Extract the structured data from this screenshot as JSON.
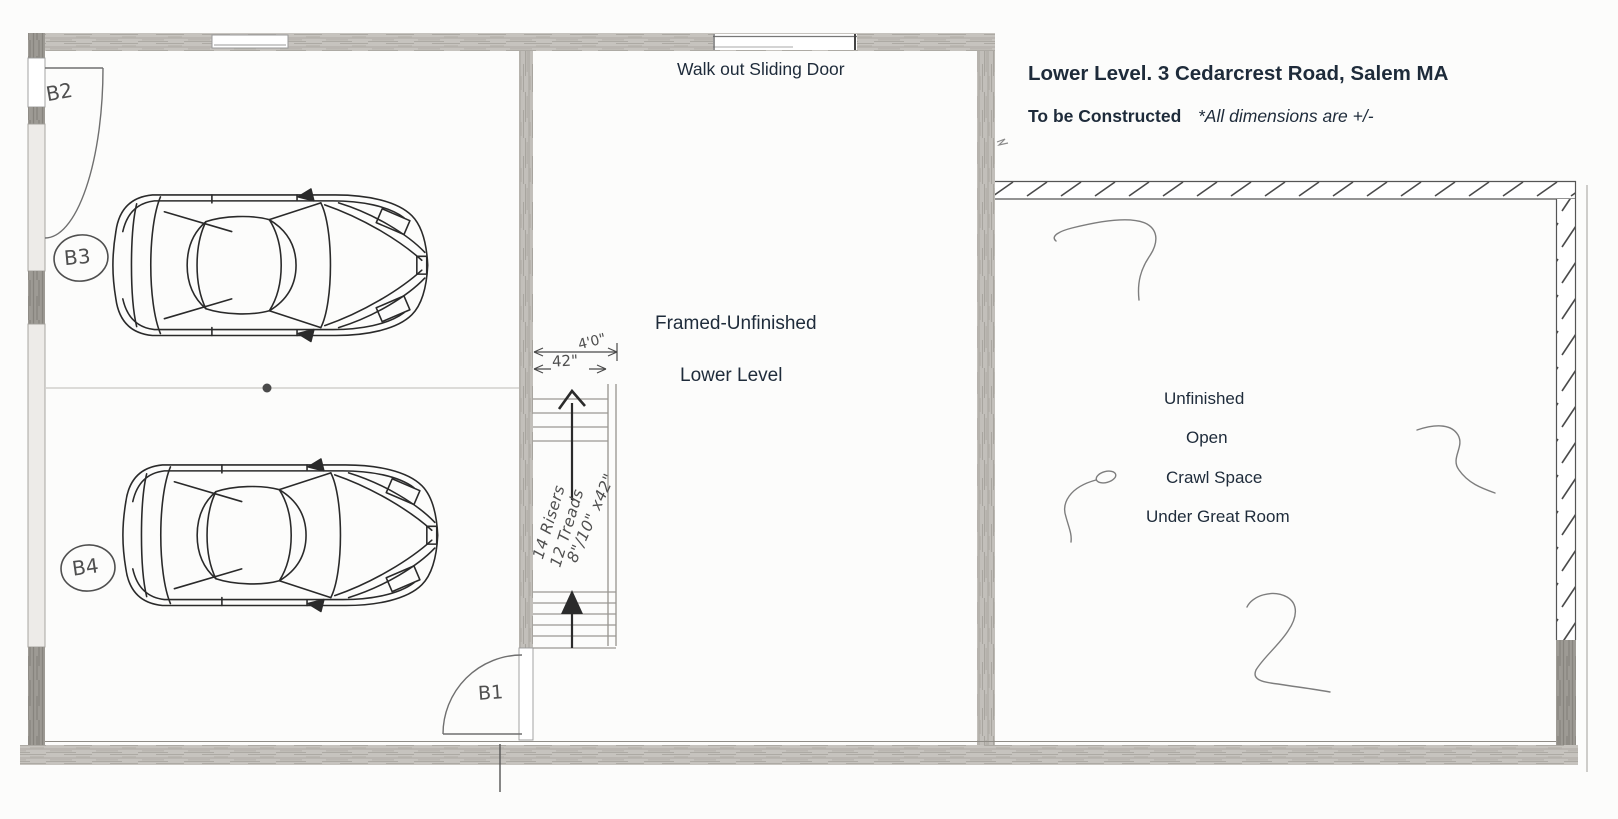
{
  "title_block": {
    "title": "Lower Level. 3 Cedarcrest Road, Salem MA",
    "status": "To be Constructed",
    "dimensions_note": "*All dimensions are +/-"
  },
  "rooms": {
    "sliding_door_label": "Walk out Sliding Door",
    "center_line1": "Framed-Unfinished",
    "center_line2": "Lower Level",
    "right_line1": "Unfinished",
    "right_line2": "Open",
    "right_line3": "Crawl Space",
    "right_line4": "Under Great Room"
  },
  "doors": {
    "b1": "B1",
    "b2": "B2",
    "b3": "B3",
    "b4": "B4"
  },
  "stairs": {
    "dim_outer": "4'0\"",
    "dim_inner": "42\"",
    "note_line1": "14 Risers",
    "note_line2": "12 Treads",
    "note_line3": "8\"/10\" x42\""
  },
  "colors": {
    "ink": "#1e2b3a",
    "pencil_wall": "#c6c3be",
    "pencil_wall_dark": "#a19e98",
    "hand_ink": "#4f4f4f"
  }
}
